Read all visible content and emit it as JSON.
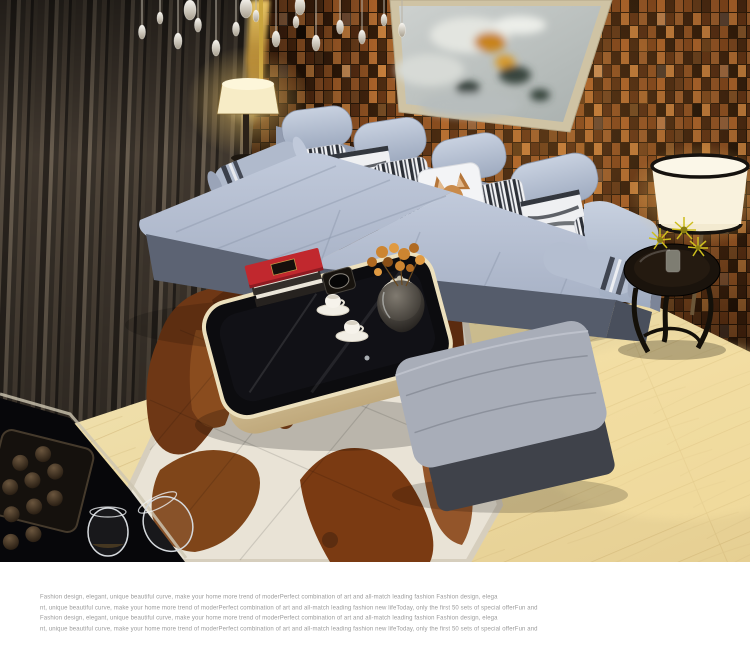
{
  "caption": {
    "lines": [
      "Fashion design, elegant, unique beautiful curve, make your home more trend of moderPerfect combination of art and  all-match leading fashion Fashion design, elega",
      "nt, unique beautiful curve, make your home more trend of moderPerfect combination of art and  all-match leading fashion new lifeToday, only the first 50 sets of special offerFun and",
      "Fashion design, elegant, unique beautiful curve, make your home more trend of moderPerfect combination of art and  all-match leading fashion Fashion design, elega",
      "nt, unique beautiful curve, make your home more trend of moderPerfect combination of art and  all-match leading fashion new lifeToday, only the first 50 sets of special offerFun and"
    ]
  },
  "photo": {
    "alt": "Modern living room: light blue-grey L-shaped fabric sectional sofa with patterned pillows and deer-print cushion, black glass coffee table with red books and white tea set, brown-and-white cowhide patch rug, wood mosaic feature wall with abstract painting, drum floor lamp, round black side table with yellow flowers, grey ottoman, crystal chandelier, dark curtains, light wood floor",
    "colors": {
      "sofa_fabric": "#aeb8cb",
      "sofa_base": "#565d6b",
      "wall_mosaic": "#8a4a1f",
      "curtain": "#4a4137",
      "floor_wood": "#ecd9a2",
      "rug_hide_brown": "#7a3c14",
      "rug_hide_white": "#e9e3d6",
      "coffee_table_top": "#0c0c0f",
      "coffee_table_base": "#ddd0a8",
      "book_red": "#c1282e",
      "lamp_shade": "#f9f2dd",
      "flower_orange": "#cd8531",
      "flower_yellow": "#d7c91f",
      "painting_accent": "#c8831a"
    }
  }
}
